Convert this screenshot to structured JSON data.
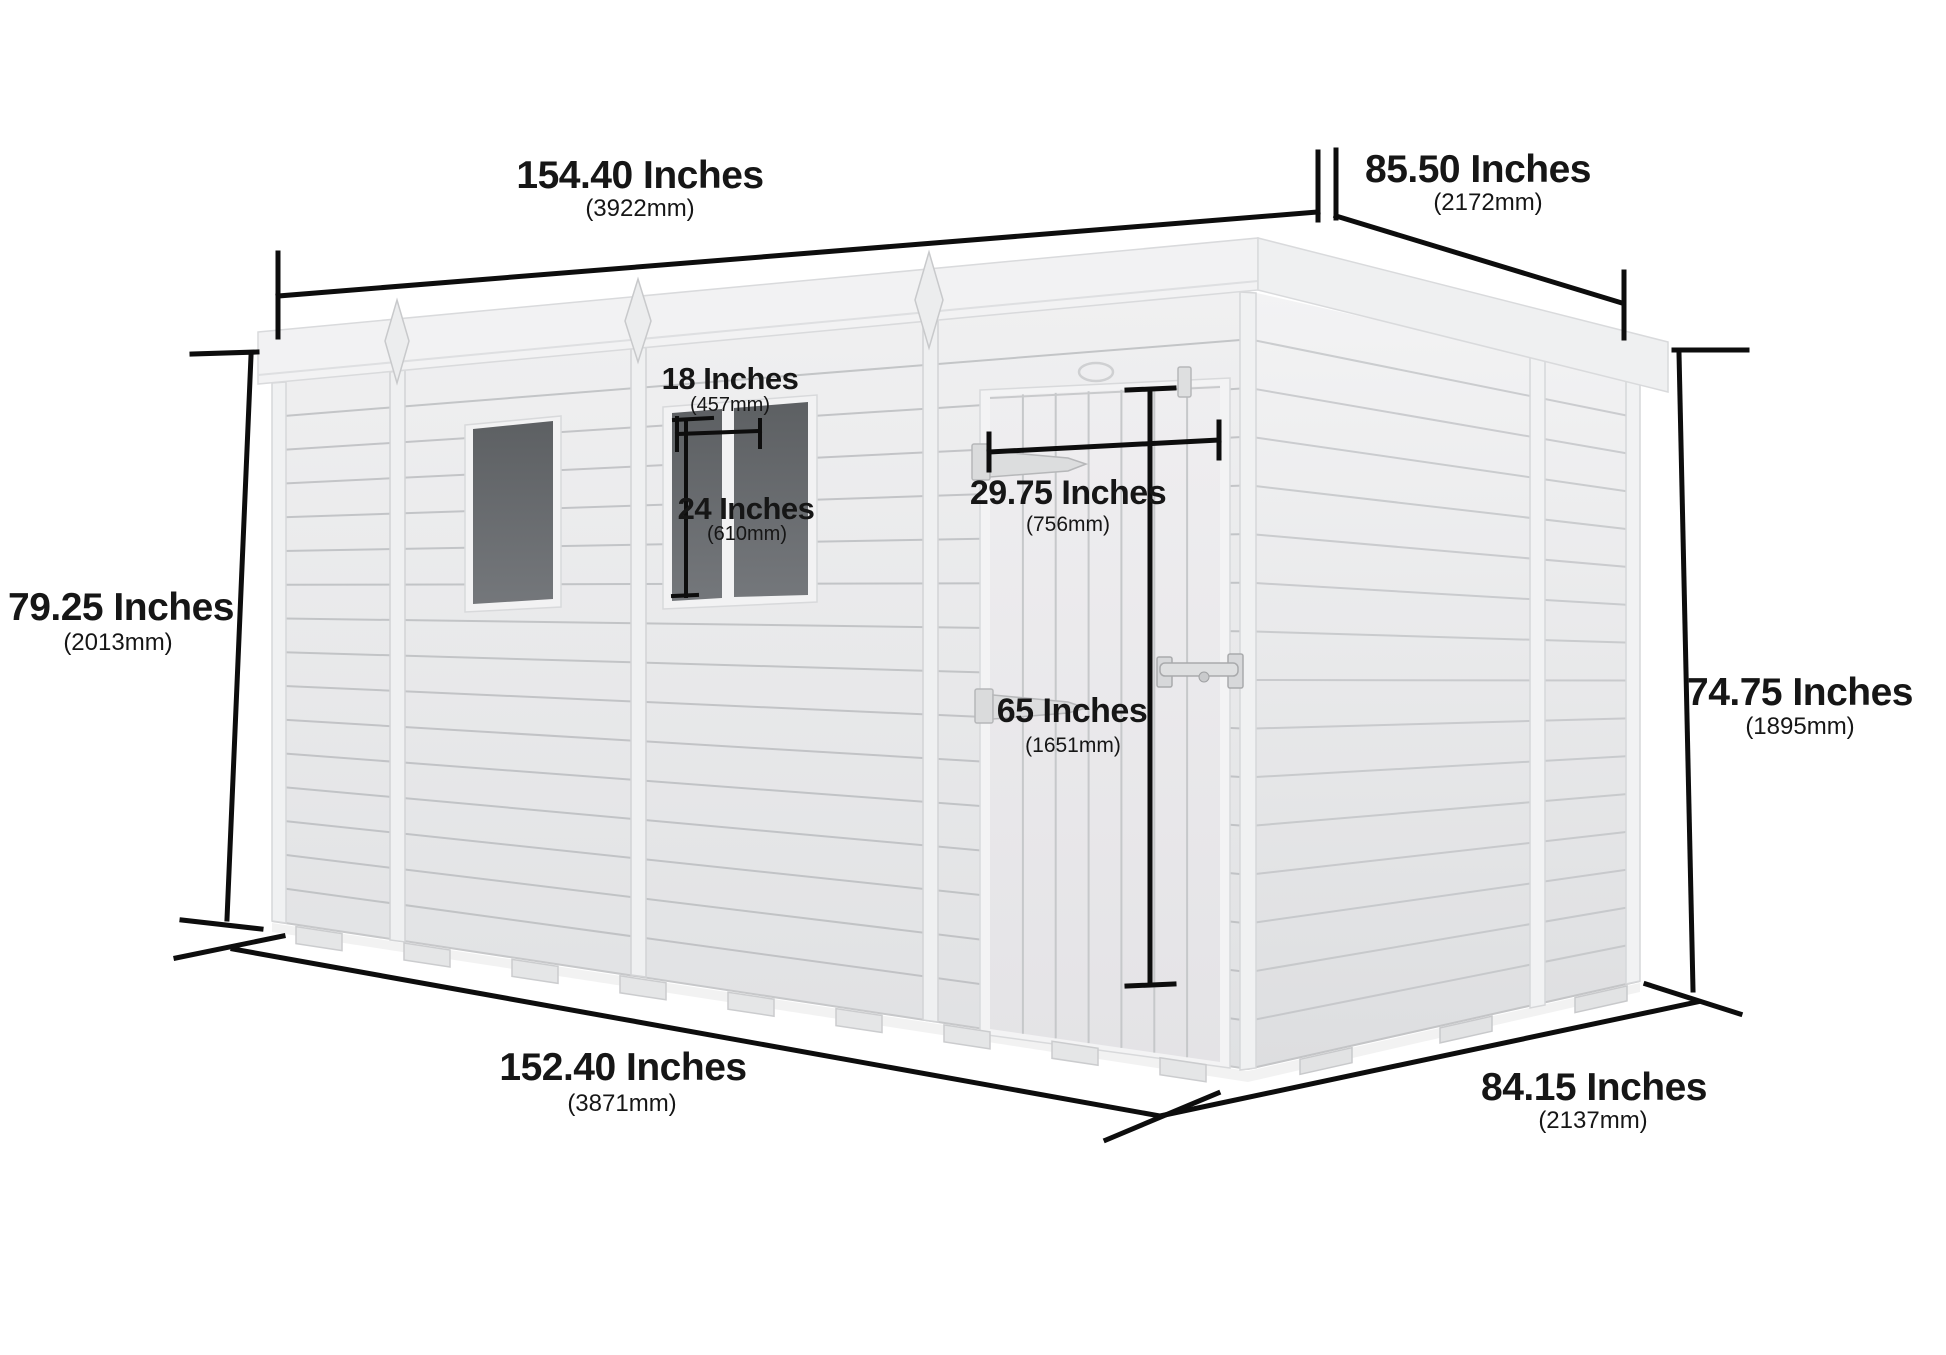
{
  "diagram": {
    "type": "shed-dimension-diagram",
    "product": "pent-shed",
    "colors": {
      "background": "#ffffff",
      "wall": "#e9eaeb",
      "roof": "#f2f2f3",
      "window_glass": "#67696c",
      "dimension_lines": "#0d0d0d",
      "dimension_text": "#161616"
    },
    "dimensions": {
      "roof_length": {
        "value": "154.40 Inches",
        "metric": "(3922mm)"
      },
      "roof_depth": {
        "value": "85.50 Inches",
        "metric": "(2172mm)"
      },
      "front_height": {
        "value": "79.25 Inches",
        "metric": "(2013mm)"
      },
      "rear_height": {
        "value": "74.75 Inches",
        "metric": "(1895mm)"
      },
      "base_length": {
        "value": "152.40 Inches",
        "metric": "(3871mm)"
      },
      "base_depth": {
        "value": "84.15 Inches",
        "metric": "(2137mm)"
      },
      "window_width": {
        "value": "18 Inches",
        "metric": "(457mm)"
      },
      "window_height": {
        "value": "24 Inches",
        "metric": "(610mm)"
      },
      "door_width": {
        "value": "29.75 Inches",
        "metric": "(756mm)"
      },
      "door_height": {
        "value": "65 Inches",
        "metric": "(1651mm)"
      }
    }
  }
}
